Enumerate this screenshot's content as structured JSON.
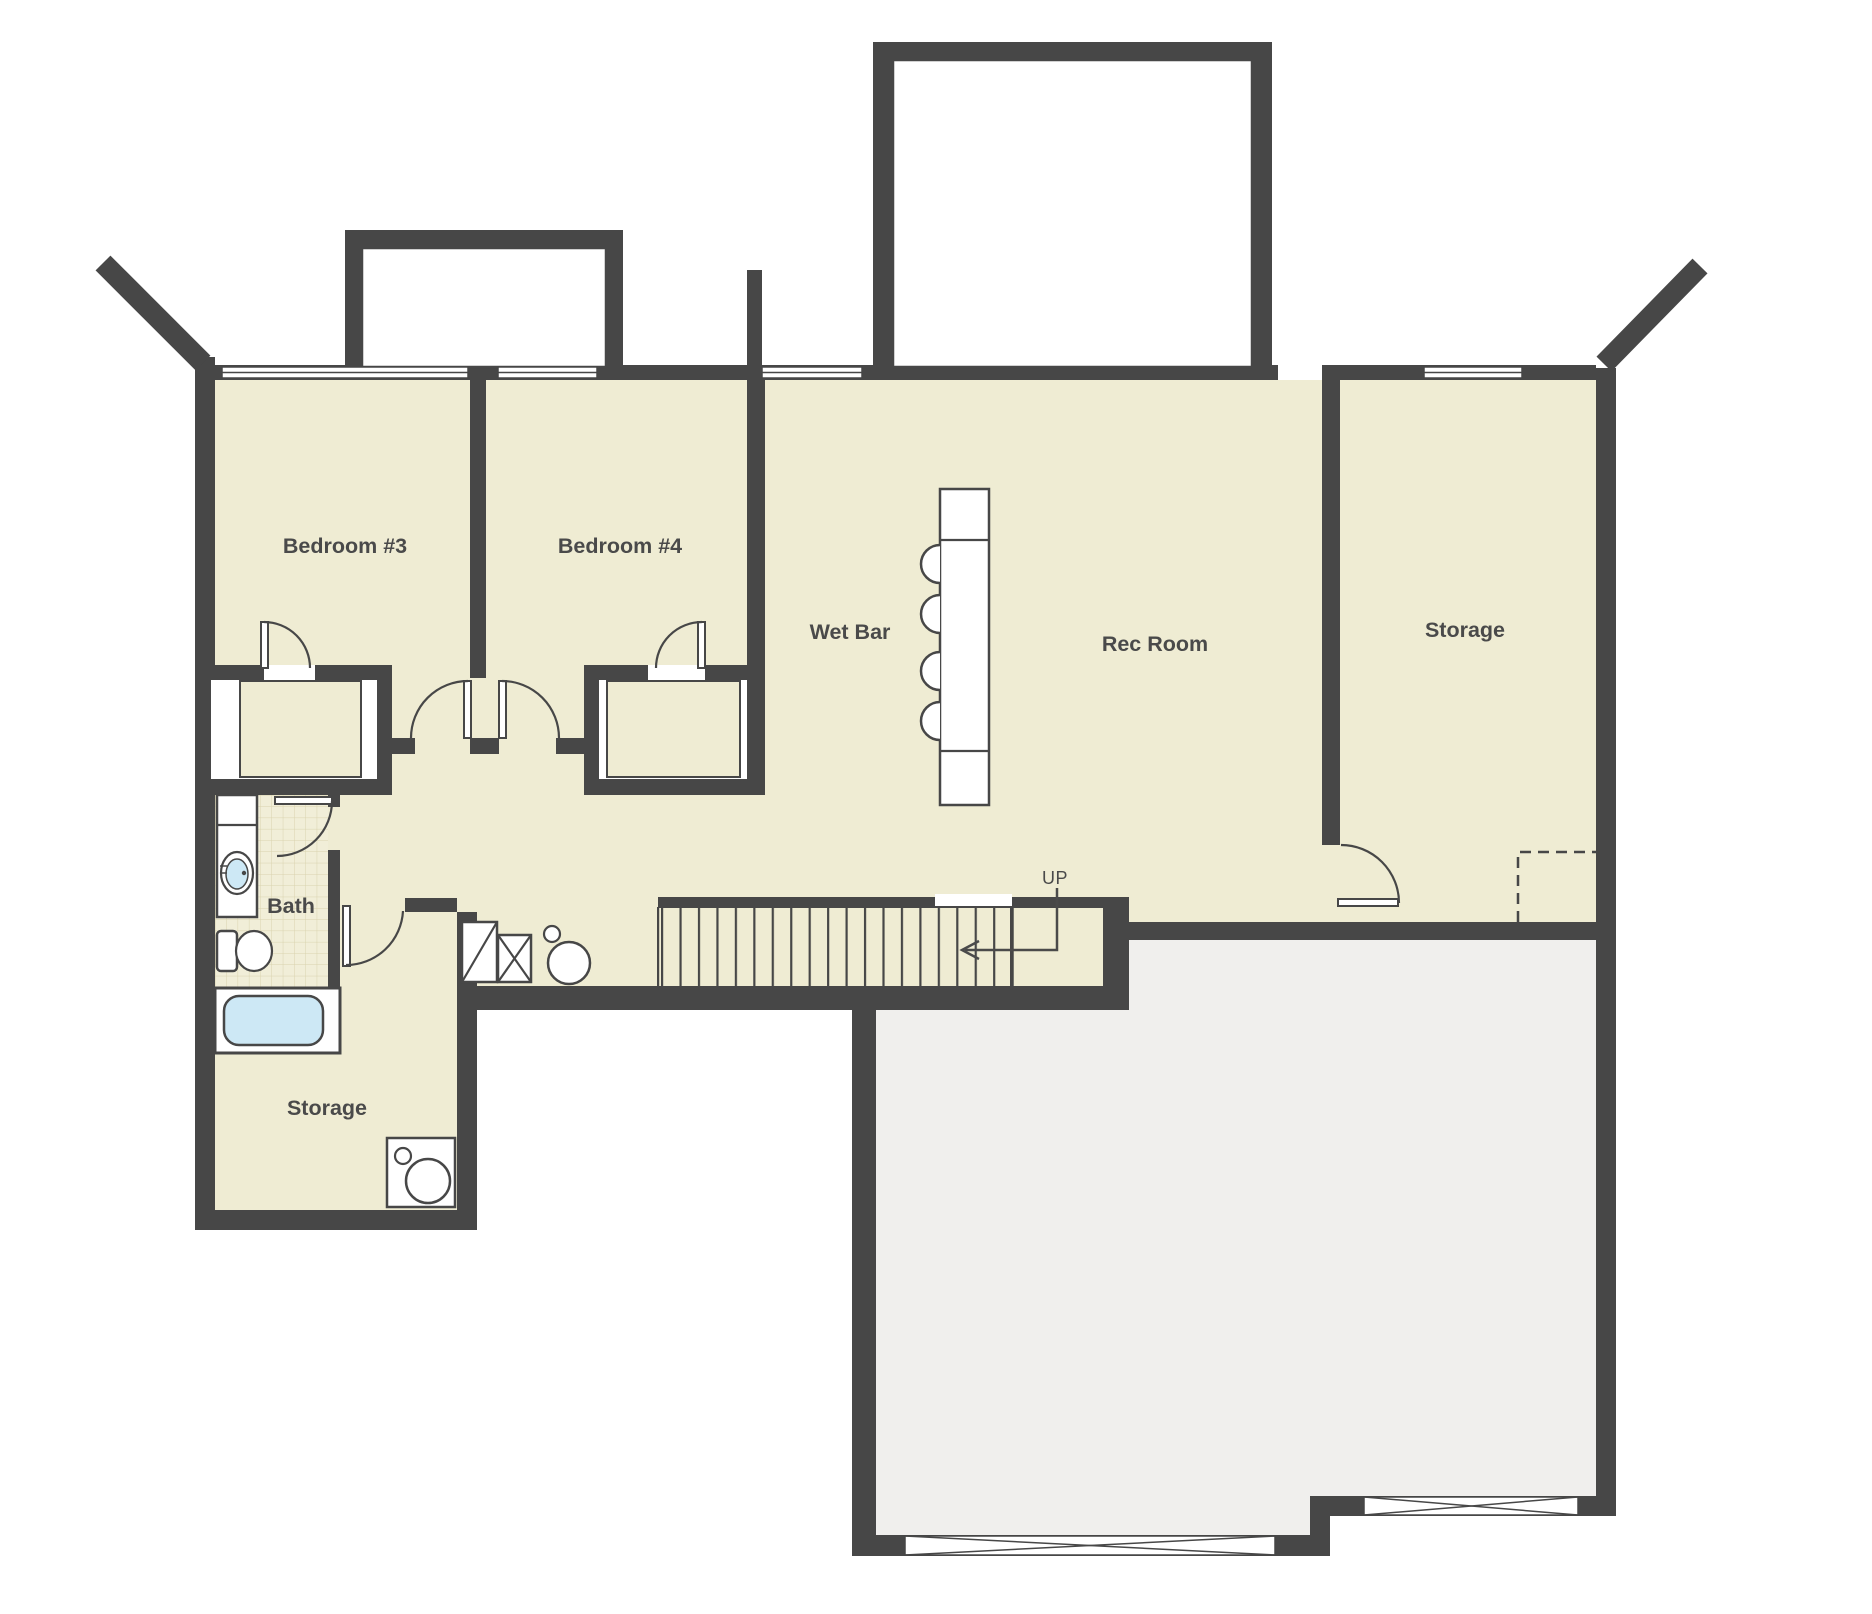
{
  "title": "Basement floor plan",
  "colors": {
    "wall": "#474747",
    "floor": "#efecd3",
    "tile": "#f1eed8",
    "tile_line": "#d9d3ae",
    "unfinished": "#f0efed",
    "tub": "#cde8f5",
    "white": "#ffffff",
    "text": "#4a4a4a"
  },
  "rooms": {
    "bedroom3": {
      "label": "Bedroom #3"
    },
    "bedroom4": {
      "label": "Bedroom #4"
    },
    "wet_bar": {
      "label": "Wet Bar"
    },
    "rec_room": {
      "label": "Rec Room"
    },
    "storage_right": {
      "label": "Storage"
    },
    "bath": {
      "label": "Bath"
    },
    "storage_lower": {
      "label": "Storage"
    }
  },
  "stairs": {
    "direction_label": "UP"
  },
  "icons": {
    "bar_counter": "rectangle counter with 4 stool semicircles",
    "bathroom_sink": "oval sink in vanity",
    "toilet": "tank and bowl symbol",
    "bathtub": "rounded blue tub",
    "washer": "square with two circles",
    "furnace_units": "squares with diagonal and X",
    "water_heater": "circle",
    "stairs_up_arrow": "left-pointing arrow with UP",
    "garage_door": "elongated X opening marker",
    "overhead_dashed_area": "dashed rectangle"
  }
}
